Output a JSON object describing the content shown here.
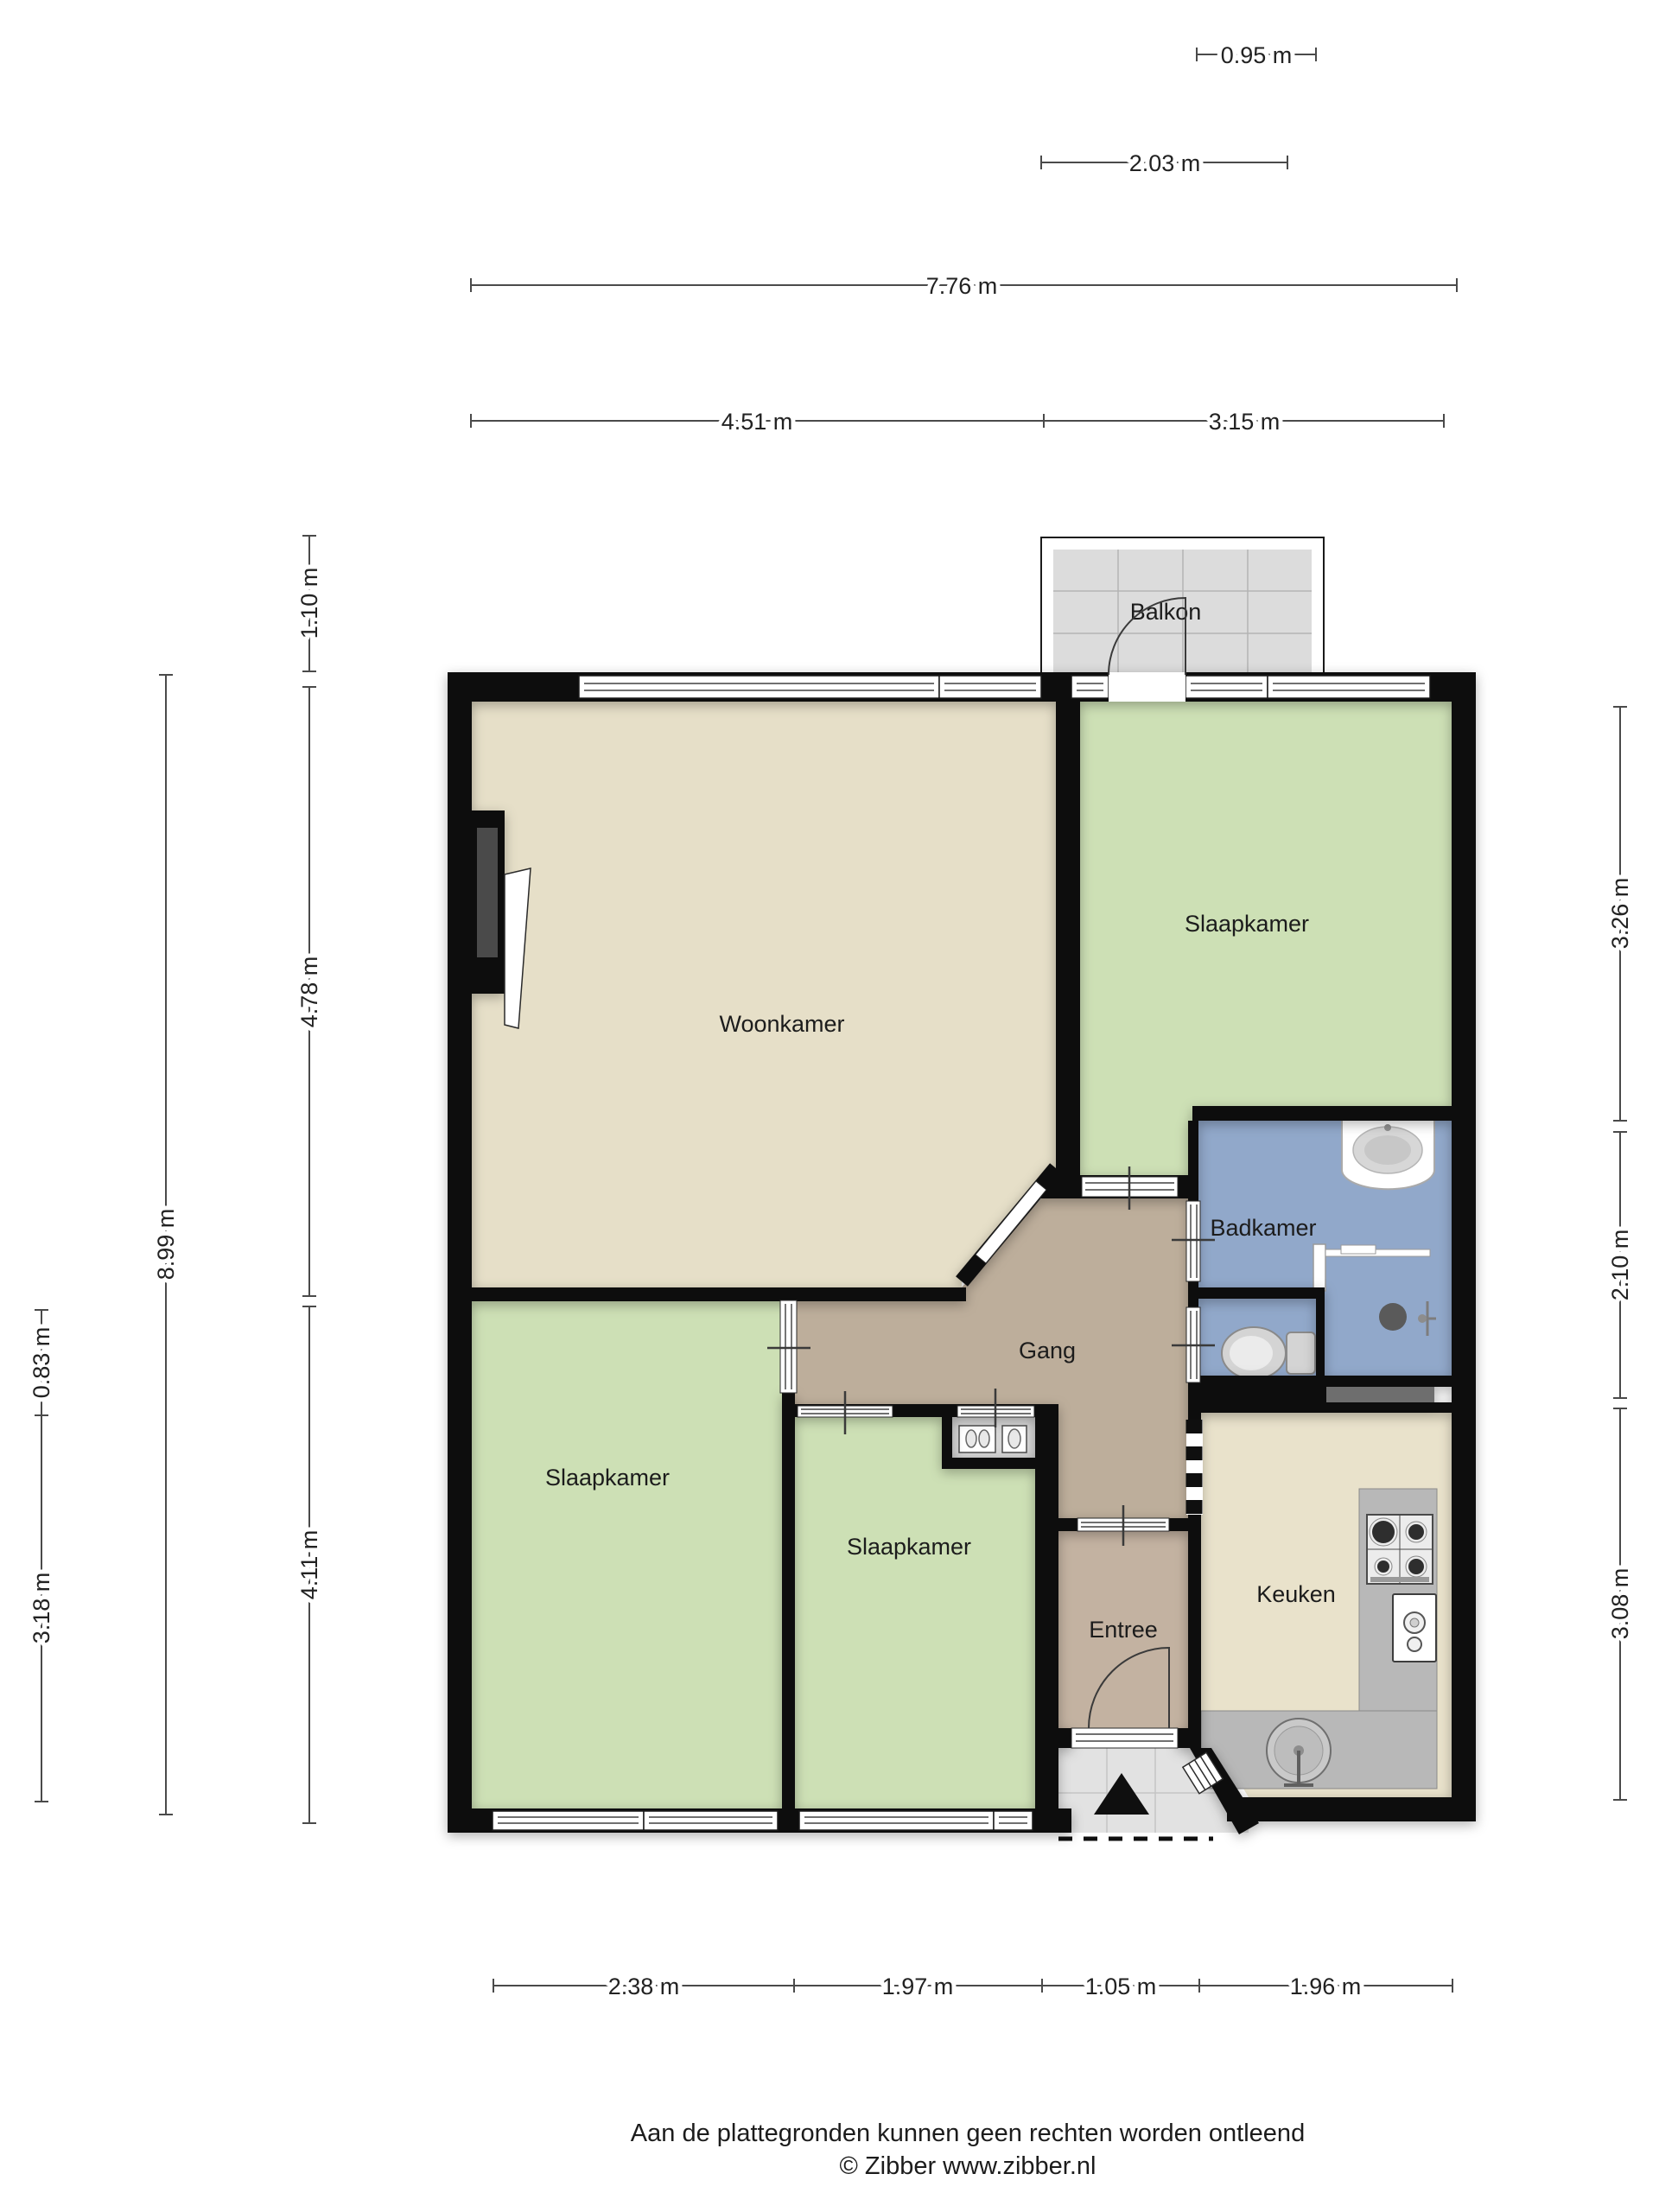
{
  "rooms": {
    "balkon": "Balkon",
    "woonkamer": "Woonkamer",
    "slaapkamer_1": "Slaapkamer",
    "badkamer": "Badkamer",
    "gang": "Gang",
    "slaapkamer_2": "Slaapkamer",
    "slaapkamer_3": "Slaapkamer",
    "entree": "Entree",
    "keuken": "Keuken"
  },
  "dimensions": {
    "top": [
      {
        "label": "0.95 m"
      },
      {
        "label": "2.03 m"
      },
      {
        "label": "7.76 m"
      },
      {
        "label": "4.51 m"
      },
      {
        "label": "3.15 m"
      }
    ],
    "left": [
      {
        "label": "1.10 m"
      },
      {
        "label": "4.78 m"
      },
      {
        "label": "8.99 m"
      },
      {
        "label": "0.83 m"
      },
      {
        "label": "3.18 m"
      },
      {
        "label": "4.11 m"
      }
    ],
    "right": [
      {
        "label": "3.26 m"
      },
      {
        "label": "2.10 m"
      },
      {
        "label": "3.08 m"
      }
    ],
    "bottom": [
      {
        "label": "2.38 m"
      },
      {
        "label": "1.97 m"
      },
      {
        "label": "1.05 m"
      },
      {
        "label": "1.96 m"
      }
    ]
  },
  "footer": {
    "line1": "Aan de plattegronden kunnen geen rechten worden ontleend",
    "line2": "© Zibber www.zibber.nl"
  },
  "colors": {
    "wall": "#0f0f0f",
    "living": "#e6dfc8",
    "bedroom": "#cde0b5",
    "bathroom": "#91a8ca",
    "hall": "#bdae9b",
    "entry": "#c3b2a1",
    "kitchen": "#e9e2cb",
    "balcony_floor": "#dcdcdc",
    "porch_floor": "#e2e2e2",
    "closet": "#d6d6d6",
    "counter": "#b8b8b8"
  }
}
